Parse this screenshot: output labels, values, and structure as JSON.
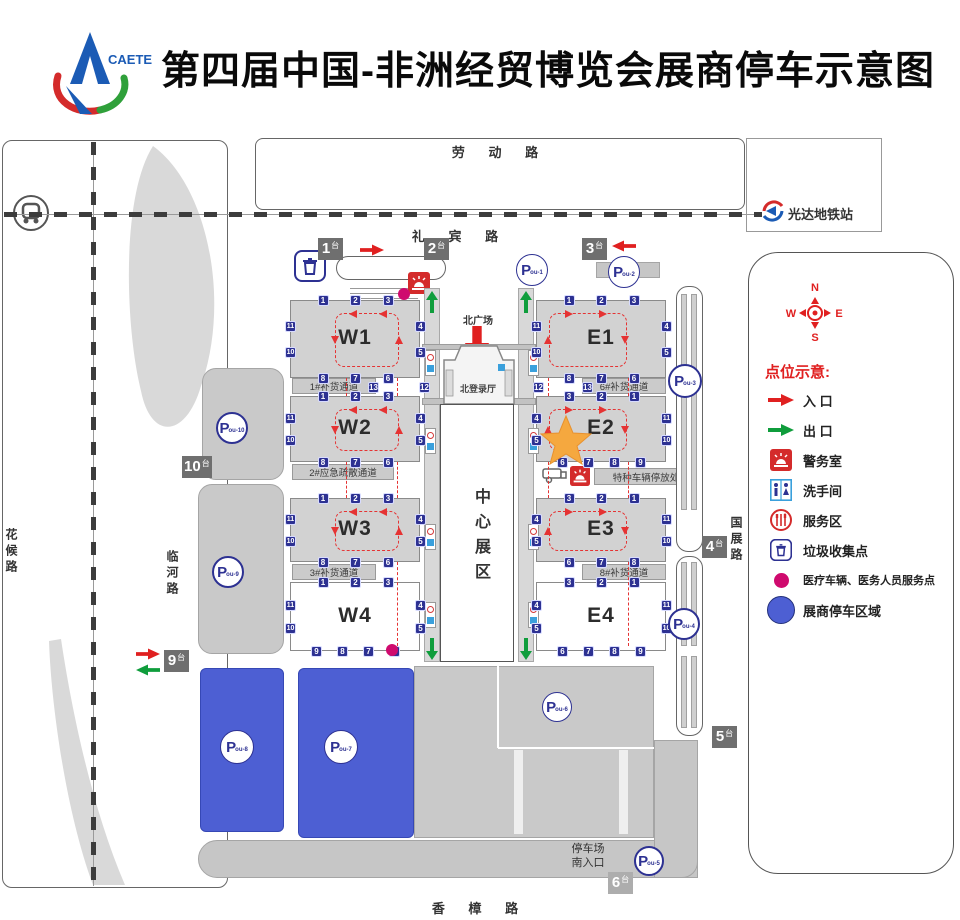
{
  "header": {
    "title": "第四届中国-非洲经贸博览会展商停车示意图",
    "logo_text": "CAETE"
  },
  "roads": {
    "laodong": "劳 动 路",
    "libin": "礼 宾 路",
    "huahou": "花候路",
    "linhe": "临河路",
    "guozhan": "国展路",
    "xiangzhang": "香 樟 路"
  },
  "station": {
    "name": "光达地铁站"
  },
  "center": {
    "north_plaza": "北广场",
    "north_hall": "北登录厅",
    "center_hall": "中心展区"
  },
  "strips": {
    "s1": "1#补货通道",
    "s2": "2#应急疏散通道",
    "s3": "3#补货通道",
    "s6": "6#补货通道",
    "s8": "8#补货通道",
    "special": "特种车辆停放处"
  },
  "south": {
    "line1": "停车场",
    "line2": "南入口"
  },
  "halls": {
    "w1": {
      "name": "W1",
      "docks": {
        "top": [
          1,
          2,
          3
        ],
        "right": [
          4,
          5
        ],
        "bottom": [
          8,
          7,
          6
        ],
        "left": [
          11,
          10
        ]
      }
    },
    "w2": {
      "name": "W2",
      "docks": {
        "top": [
          1,
          2,
          3
        ],
        "right": [
          4,
          5
        ],
        "bottom": [
          8,
          7,
          6
        ],
        "left": [
          11,
          10
        ]
      }
    },
    "w3": {
      "name": "W3",
      "docks": {
        "top": [
          1,
          2,
          3
        ],
        "right": [
          4,
          5
        ],
        "bottom": [
          8,
          7,
          6
        ],
        "left": [
          11,
          10
        ]
      }
    },
    "w4": {
      "name": "W4",
      "docks": {
        "top": [
          1,
          2,
          3
        ],
        "right": [
          4,
          5
        ],
        "bottom": [
          9,
          8,
          7,
          6
        ],
        "left": [
          11,
          10
        ]
      }
    },
    "e1": {
      "name": "E1",
      "docks": {
        "top": [
          1,
          2,
          3
        ],
        "right": [
          4,
          5
        ],
        "bottom": [
          8,
          7,
          6
        ],
        "left": [
          11,
          10
        ]
      }
    },
    "e2": {
      "name": "E2",
      "docks": {
        "top": [
          3,
          2,
          1
        ],
        "right": [
          11,
          10
        ],
        "bottom": [
          6,
          7,
          8,
          9
        ],
        "left": [
          4,
          5
        ]
      }
    },
    "e3": {
      "name": "E3",
      "docks": {
        "top": [
          3,
          2,
          1
        ],
        "right": [
          11,
          10
        ],
        "bottom": [
          6,
          7,
          8
        ],
        "left": [
          4,
          5
        ]
      }
    },
    "e4": {
      "name": "E4",
      "docks": {
        "top": [
          3,
          2,
          1
        ],
        "right": [
          11,
          10
        ],
        "bottom": [
          6,
          7,
          8,
          9
        ],
        "left": [
          4,
          5
        ]
      }
    }
  },
  "extra_badges": {
    "w13": "13",
    "w12": "12",
    "e12": "12",
    "e13": "13"
  },
  "gates": {
    "g1": {
      "num": "1",
      "suffix": "台"
    },
    "g2": {
      "num": "2",
      "suffix": "台"
    },
    "g3": {
      "num": "3",
      "suffix": "台"
    },
    "g4": {
      "num": "4",
      "suffix": "台"
    },
    "g5": {
      "num": "5",
      "suffix": "台"
    },
    "g6": {
      "num": "6",
      "suffix": "台"
    },
    "g9": {
      "num": "9",
      "suffix": "台"
    },
    "g10": {
      "num": "10",
      "suffix": "台"
    }
  },
  "parkings": {
    "p1": {
      "p": "P",
      "sub": "ou-1"
    },
    "p2": {
      "p": "P",
      "sub": "ou-2"
    },
    "p3": {
      "p": "P",
      "sub": "ou-3"
    },
    "p4": {
      "p": "P",
      "sub": "ou-4"
    },
    "p5": {
      "p": "P",
      "sub": "ou-5"
    },
    "p6": {
      "p": "P",
      "sub": "ou-6"
    },
    "p7": {
      "p": "P",
      "sub": "ou-7"
    },
    "p8": {
      "p": "P",
      "sub": "ou-8"
    },
    "p9": {
      "p": "P",
      "sub": "ou-9"
    },
    "p10": {
      "p": "P",
      "sub": "ou-10"
    }
  },
  "legend": {
    "title": "点位示意:",
    "compass": {
      "n": "N",
      "s": "S",
      "e": "E",
      "w": "W"
    },
    "items": [
      {
        "label": "入 口",
        "icon": "entry-arrow"
      },
      {
        "label": "出 口",
        "icon": "exit-arrow"
      },
      {
        "label": "警务室",
        "icon": "police"
      },
      {
        "label": "洗手间",
        "icon": "restroom"
      },
      {
        "label": "服务区",
        "icon": "service"
      },
      {
        "label": "垃圾收集点",
        "icon": "trash"
      },
      {
        "label": "医疗车辆、医务人员服务点",
        "icon": "medical-dot"
      },
      {
        "label": "展商停车区域",
        "icon": "parking-area"
      }
    ]
  }
}
